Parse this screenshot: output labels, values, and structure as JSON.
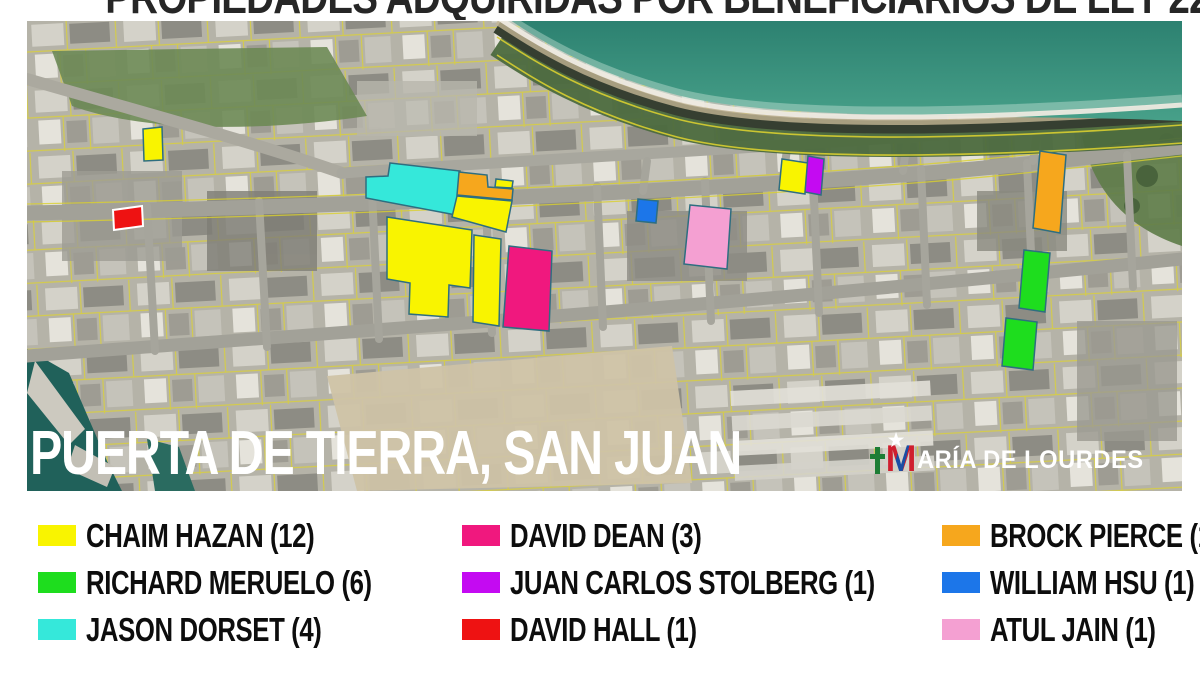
{
  "title": "PROPIEDADES ADQUIRIDAS POR BENEFICIARIOS DE LEY 22",
  "map": {
    "label": "PUERTA DE TIERRA, SAN JUAN",
    "watermark": {
      "m": "M",
      "rest": "ARÍA DE LOURDES"
    },
    "parcel_stroke": "#2E6E80",
    "parcels": [
      {
        "owner": "CHAIM HAZAN",
        "color": "#F9F400",
        "points": "116,108 135,106 136,139 117,140"
      },
      {
        "owner": "DAVID HALL",
        "color": "#EE1212",
        "stroke": "#FFFFFF",
        "points": "86,189 115,185 116,205 87,209"
      },
      {
        "owner": "JASON DORSET",
        "color": "#35E8DA",
        "points": "363,142 433,150 429,194 339,177 339,156 361,155"
      },
      {
        "owner": "BROCK PIERCE",
        "color": "#F6A71D",
        "points": "432,151 460,154 461,166 486,168 485,179 430,174"
      },
      {
        "owner": "CHAIM HAZAN",
        "color": "#F9F400",
        "points": "469,158 486,160 485,167 468,166"
      },
      {
        "owner": "CHAIM HAZAN",
        "color": "#F9F400",
        "points": "430,175 485,180 479,211 425,196"
      },
      {
        "owner": "CHAIM HAZAN",
        "color": "#F9F400",
        "points": "360,196 445,209 443,267 422,264 421,296 382,293 383,262 360,258"
      },
      {
        "owner": "CHAIM HAZAN",
        "color": "#F9F400",
        "points": "447,214 474,218 472,305 446,301"
      },
      {
        "owner": "DAVID DEAN",
        "color": "#F0187E",
        "points": "482,225 525,230 522,310 476,306"
      },
      {
        "owner": "CHAIM HAZAN",
        "color": "#F9F400",
        "points": "755,138 781,142 778,173 752,169"
      },
      {
        "owner": "JUAN CARLOS STOLBERG",
        "color": "#C40AF2",
        "points": "781,135 797,138 794,174 778,171"
      },
      {
        "owner": "WILLIAM HSU",
        "color": "#1C76E9",
        "points": "611,178 631,180 629,202 609,200"
      },
      {
        "owner": "ATUL JAIN",
        "color": "#F4A0D2",
        "points": "663,184 704,188 700,248 657,243"
      },
      {
        "owner": "BROCK PIERCE",
        "color": "#F6A71D",
        "points": "1013,130 1039,134 1033,212 1006,207"
      },
      {
        "owner": "RICHARD MERUELO",
        "color": "#1EDD1E",
        "points": "997,229 1023,232 1018,291 992,287"
      },
      {
        "owner": "RICHARD MERUELO",
        "color": "#1EDD1E",
        "points": "979,297 1010,301 1006,349 975,345"
      }
    ]
  },
  "legend": {
    "columns": [
      [
        {
          "label": "CHAIM HAZAN (12)",
          "color": "#F9F400"
        },
        {
          "label": "RICHARD MERUELO (6)",
          "color": "#1EDD1E"
        },
        {
          "label": "JASON DORSET (4)",
          "color": "#35E8DA"
        }
      ],
      [
        {
          "label": "DAVID DEAN (3)",
          "color": "#F0187E"
        },
        {
          "label": "JUAN CARLOS STOLBERG (1)",
          "color": "#C40AF2"
        },
        {
          "label": "DAVID HALL (1)",
          "color": "#EE1212"
        }
      ],
      [
        {
          "label": "BROCK PIERCE (1)",
          "color": "#F6A71D"
        },
        {
          "label": "WILLIAM HSU (1)",
          "color": "#1C76E9"
        },
        {
          "label": "ATUL JAIN (1)",
          "color": "#F4A0D2"
        }
      ]
    ]
  }
}
